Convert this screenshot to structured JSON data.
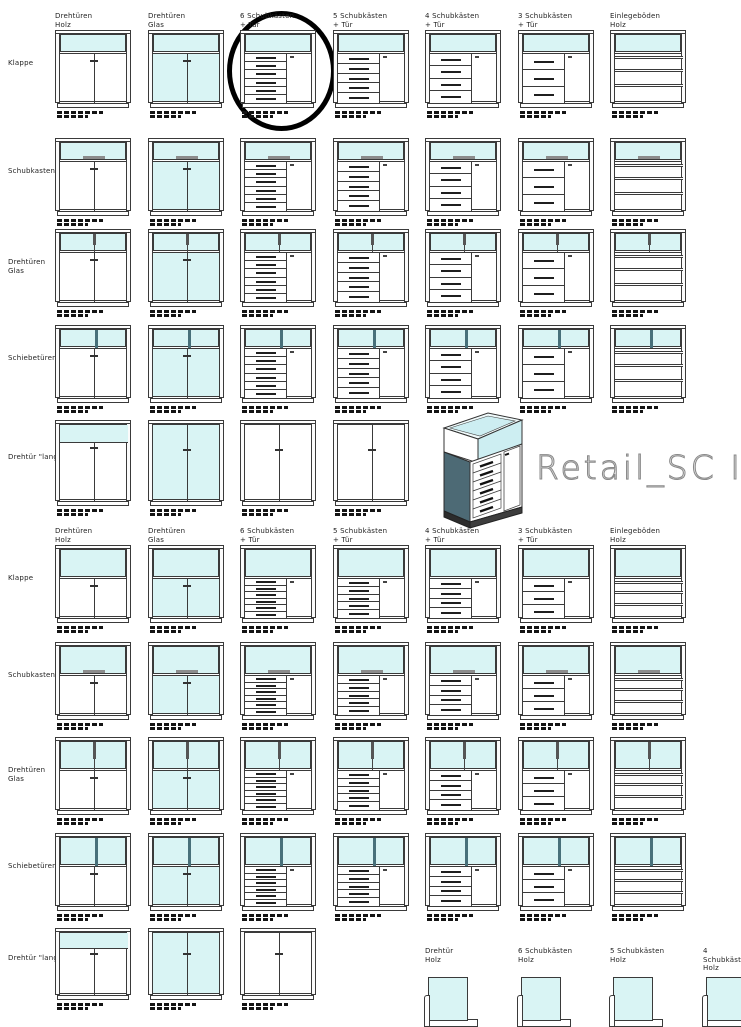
{
  "brand": {
    "title": "Retail_SC II"
  },
  "colors": {
    "glass": "#d9f4f4",
    "glass_3d": "#cdeef2",
    "outline": "#3a3a3a",
    "handle_dark": "#1f1f1f",
    "handle_gray": "#8c8c8c",
    "slider_teal": "#48707a",
    "slate_side": "#4d6a75",
    "brand_text": "#8a8a8a",
    "annotation": "#000000"
  },
  "column_headers": [
    {
      "line1": "Drehtüren",
      "line2": "Holz"
    },
    {
      "line1": "Drehtüren",
      "line2": "Glas"
    },
    {
      "line1": "6 Schubkästen",
      "line2": "+ Tür"
    },
    {
      "line1": "5 Schubkästen",
      "line2": "+ Tür"
    },
    {
      "line1": "4 Schubkästen",
      "line2": "+ Tür"
    },
    {
      "line1": "3 Schubkästen",
      "line2": "+ Tür"
    },
    {
      "line1": "Einlegeböden",
      "line2": "Holz"
    }
  ],
  "column_body_types": [
    "doors_wood",
    "doors_glass",
    "drawers6",
    "drawers5",
    "drawers4",
    "drawers3",
    "shelves"
  ],
  "row_labels": [
    {
      "label": "Klappe",
      "top": "plain"
    },
    {
      "label": "Schubkasten",
      "top": "drawer"
    },
    {
      "label": "Drehtüren\nGlas",
      "top": "glass_doors"
    },
    {
      "label": "Schiebetüren",
      "top": "sliding"
    },
    {
      "label": "Drehtür \"lang\"",
      "top": "lang"
    }
  ],
  "lang_bodies": {
    "section1": [
      "lang_wood",
      "lang_glass",
      "lang_white",
      "lang_white"
    ],
    "section2": [
      "lang_wood",
      "lang_glass",
      "lang_white"
    ]
  },
  "mini_section": {
    "items": [
      {
        "line1": "Drehtür",
        "line2": "Holz"
      },
      {
        "line1": "6 Schubkästen",
        "line2": "Holz"
      },
      {
        "line1": "5 Schubkästen",
        "line2": "Holz"
      },
      {
        "line1": "4 Schubkästen",
        "line2": "Holz"
      }
    ]
  }
}
